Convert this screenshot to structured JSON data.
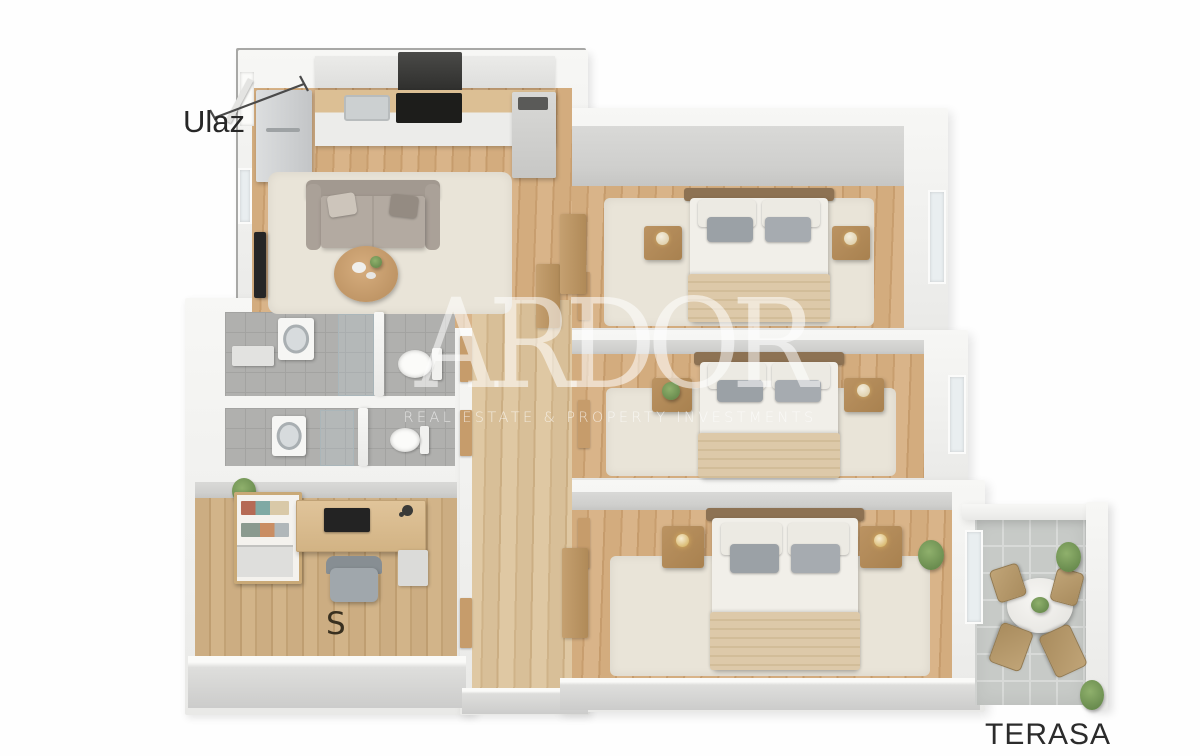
{
  "scene": {
    "description": "isometric 3D floor plan render of a three-bedroom apartment with terrace",
    "background": "#ffffff"
  },
  "labels": {
    "entrance": "Ulaz",
    "study": "S",
    "terrace": "TERASA"
  },
  "watermark": {
    "title": "ARDOR",
    "subtitle": "REAL ESTATE & PROPERTY INVESTMENTS",
    "color": "#ffffff"
  },
  "colors": {
    "wall": "#f3f3f1",
    "wall_face": "#cfcfcd",
    "wood_floor": "#cfa87a",
    "hallway_wood": "#d8c09b",
    "bathroom_tile": "#b0b0ae",
    "terrace_tile": "#c7cac7",
    "rug": "#e9e4d8",
    "bed_blanket": "#d9c5a6",
    "pillow_gray": "#9ba1a6",
    "sofa": "#a89f96",
    "label_text": "#2c2c2c"
  }
}
